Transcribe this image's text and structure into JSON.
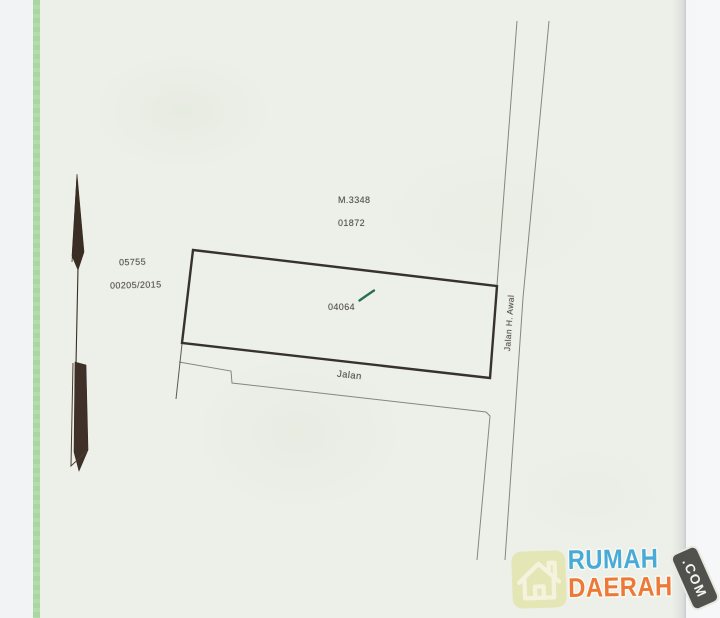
{
  "document": {
    "labels": {
      "block_ref": "M.3348",
      "block_ref2": "01872",
      "left_ref": "05755",
      "left_ref2": "00205/2015",
      "parcel_number": "04064",
      "road_bottom_label": "Jalan",
      "road_right_label": "Jalan H. Awal"
    }
  },
  "watermark": {
    "brand_line1": "RUMAH",
    "brand_line2": "DAERAH",
    "badge_label": ".COM",
    "colors": {
      "brand_blue": "#41a8d8",
      "brand_orange": "#ee7531",
      "badge_bg": "#4b4b48",
      "house_badge_bg": "#e4e6b4",
      "house_icon_stroke": "#f6f3dd"
    }
  },
  "colors": {
    "page_border_green": "#a8d7a2",
    "paper": "#edf0e9",
    "parcel_outline_ink": "#37322b",
    "road_line_gray": "#84867f",
    "label_text": "#54524b",
    "check_mark_green": "#2a6f50",
    "north_arrow_fill": "#3a2d23"
  }
}
